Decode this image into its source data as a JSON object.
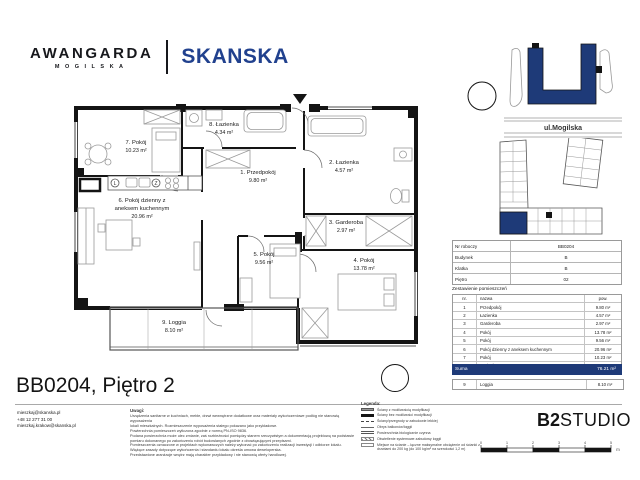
{
  "colors": {
    "navy_accent": "#1e3a78",
    "skanska_blue": "#21418e",
    "wall_black": "#141414"
  },
  "header": {
    "brand_primary": "AWANGARDA",
    "brand_sub": "MOGILSKA",
    "brand_secondary": "SKANSKA"
  },
  "site_map": {
    "street_label": "ul.Mogilska",
    "compass_label": "N"
  },
  "unit_info": {
    "title": "BB0204, Piętro 2",
    "rows": [
      {
        "label": "Nr roboczy",
        "value": "BB0204"
      },
      {
        "label": "Budynek",
        "value": "B"
      },
      {
        "label": "Klatka",
        "value": "B"
      },
      {
        "label": "Piętro",
        "value": "02"
      }
    ]
  },
  "rooms_table": {
    "title": "Zestawienie pomieszczeń",
    "columns": {
      "nr": "nr.",
      "name": "nazwa",
      "area": "pow."
    },
    "rows": [
      {
        "nr": "1",
        "name": "Przedpokój",
        "area": "9.80 m²"
      },
      {
        "nr": "2",
        "name": "Łazienka",
        "area": "4.57 m²"
      },
      {
        "nr": "3",
        "name": "Garderoba",
        "area": "2.97 m²"
      },
      {
        "nr": "4",
        "name": "Pokój",
        "area": "13.78 m²"
      },
      {
        "nr": "5",
        "name": "Pokój",
        "area": "9.56 m²"
      },
      {
        "nr": "6",
        "name": "Pokój dzienny z aneksem kuchennym",
        "area": "20.96 m²"
      },
      {
        "nr": "7",
        "name": "Pokój",
        "area": "10.23 m²"
      },
      {
        "nr": "8",
        "name": "Łazienka",
        "area": "4.34 m²"
      }
    ],
    "sum_label": "Suma",
    "sum_value": "76.21 m²",
    "extra_row": {
      "nr": "9",
      "name": "Loggia",
      "area": "8.10 m²"
    }
  },
  "plan": {
    "r1": {
      "name": "1. Przedpokój",
      "area": "9.80 m²"
    },
    "r2": {
      "name": "2. Łazienka",
      "area": "4.57 m²"
    },
    "r3": {
      "name": "3. Garderoba",
      "area": "2.97 m²"
    },
    "r4": {
      "name": "4. Pokój",
      "area": "13.78 m²"
    },
    "r5": {
      "name": "5. Pokój",
      "area": "9.56 m²"
    },
    "r6": {
      "name": "6. Pokój dzienny z",
      "name2": "aneksem kuchennym",
      "area": "20.96 m²"
    },
    "r7": {
      "name": "7. Pokój",
      "area": "10.23 m²"
    },
    "r8": {
      "name": "8. Łazienka",
      "area": "4.34 m²"
    },
    "r9": {
      "name": "9. Loggia",
      "area": "8.10 m²"
    },
    "kitchen": {
      "fridge": "L",
      "dishwasher": "Z"
    },
    "compass_label": "N"
  },
  "footer": {
    "contact_lines": [
      "mieszkaj@skanska.pl",
      "+48 12 277 31 00",
      "mieszkaj.krakow@skanska.pl"
    ],
    "uwagi_title": "Uwagi:",
    "uwagi_lines": [
      "Urządzenia sanitarne w kuchniach, meble, drzwi wewnętrzne dodatkowe oraz materiały wykończeniowe podłóg nie stanowią wyposażenia",
      "lokali mieszkalnych. Rozmieszczenie wyposażenia stałego pokazano jako przykładowe.",
      "Powierzchnia pomieszczeń wyliczona zgodnie z normą PN-ISO 9836.",
      "Podana powierzchnia może ulec zmianie, zaś rozbieżności pomiędzy stanem rzeczywistym a dokumentacją projektową na podstawie",
      "pomiaru dokonanego po zakończeniu robót budowlanych zgodnie z obowiązującymi przepisami.",
      "Pomieszczenia oznaczone w projektach wykonawczych należy wykonać po zakończeniu realizacji inwestycji i odbiorze lokalu.",
      "Wiążące zasady dotyczące wykończenia i standardu lokalu określa umowa deweloperska.",
      "Przedstawione aranżacje wnętrz mają charakter przykładowy i nie stanowią oferty handlowej."
    ],
    "legend_title": "Legenda:",
    "legend_items": [
      "Ściany z możliwością modyfikacji",
      "Ściany bez możliwości modyfikacji",
      "Ściany/przegrody w zabudowie lekkiej",
      "Obrys balkonów/loggii",
      "Powierzchnia biologicznie czynna",
      "Oświetlenie systemowe zabudowy loggii",
      "Miejsce na ścianie – łączne maksymalne obciążenie od ścianki z drzwiami do 200 kg (do 100 kg/m² na szerokości 1,2 m)"
    ],
    "studio_bold": "B2",
    "studio_rest": "STUDIO",
    "scale_ticks": [
      "0",
      "1",
      "2",
      "3",
      "4",
      "5"
    ],
    "scale_unit": "m"
  }
}
